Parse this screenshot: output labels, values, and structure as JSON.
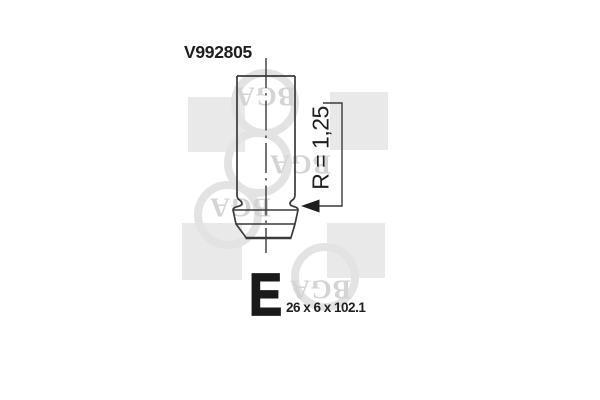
{
  "image": {
    "kind": "engine-valve-technical-drawing",
    "background": "#ffffff"
  },
  "part": {
    "number": "V992805",
    "radius_annotation": "R = 1,25",
    "size_class_letter": "E",
    "dimensions": "26 x 6 x 102.1"
  },
  "watermark": {
    "brand": "BGA"
  },
  "colors": {
    "line": "#3a3a3a",
    "text": "#1f1f1f",
    "watermark_square": "#e9e9e9",
    "watermark_ring": "#e3e3e3",
    "watermark_text": "#d4d4d4"
  }
}
